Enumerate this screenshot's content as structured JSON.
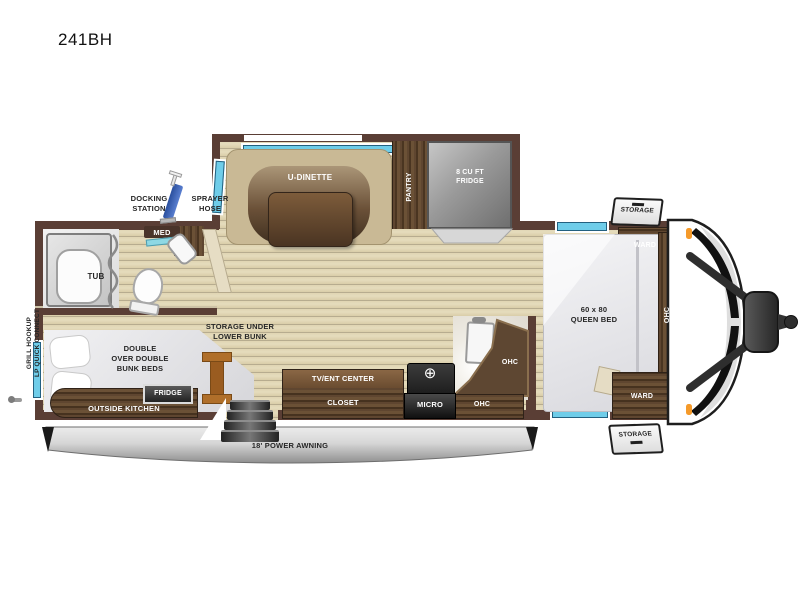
{
  "title": "241BH",
  "plan": {
    "slide_out": {
      "dinette": "U-DINETTE",
      "pantry": "PANTRY",
      "fridge": "8 CU FT\nFRIDGE"
    },
    "bath": {
      "tub": "TUB",
      "med": "MED"
    },
    "exterior": {
      "docking": "DOCKING\nSTATION",
      "sprayer": "SPRAYER\nHOSE",
      "grill": "GRILL HOOKUP\nLP QUICK CONNECT",
      "awning": "18' POWER AWNING",
      "storage_front": "STORAGE",
      "storage_rear": "STORAGE"
    },
    "bunk_room": {
      "bunks": "DOUBLE\nOVER DOUBLE\nBUNK BEDS",
      "storage_under": "STORAGE UNDER\nLOWER BUNK",
      "outside_kitchen": "OUTSIDE KITCHEN",
      "fridge": "FRIDGE"
    },
    "living": {
      "tv": "TV/ENT CENTER",
      "closet": "CLOSET",
      "micro": "MICRO",
      "ohc_corner": "OHC",
      "ohc_lower": "OHC"
    },
    "bedroom": {
      "bed": "60 x 80\nQUEEN BED",
      "ward_front": "WARD",
      "ward_rear": "WARD",
      "ohc": "OHC"
    }
  },
  "colors": {
    "wall": "#5a3e35",
    "wood": "#5b4330",
    "floor": "#ddd2af",
    "window": "#6fcde9",
    "counter_teal": "#8ed8e4",
    "accent_orange": "#f59a2a",
    "awning_silver": "#c9c9c9"
  }
}
